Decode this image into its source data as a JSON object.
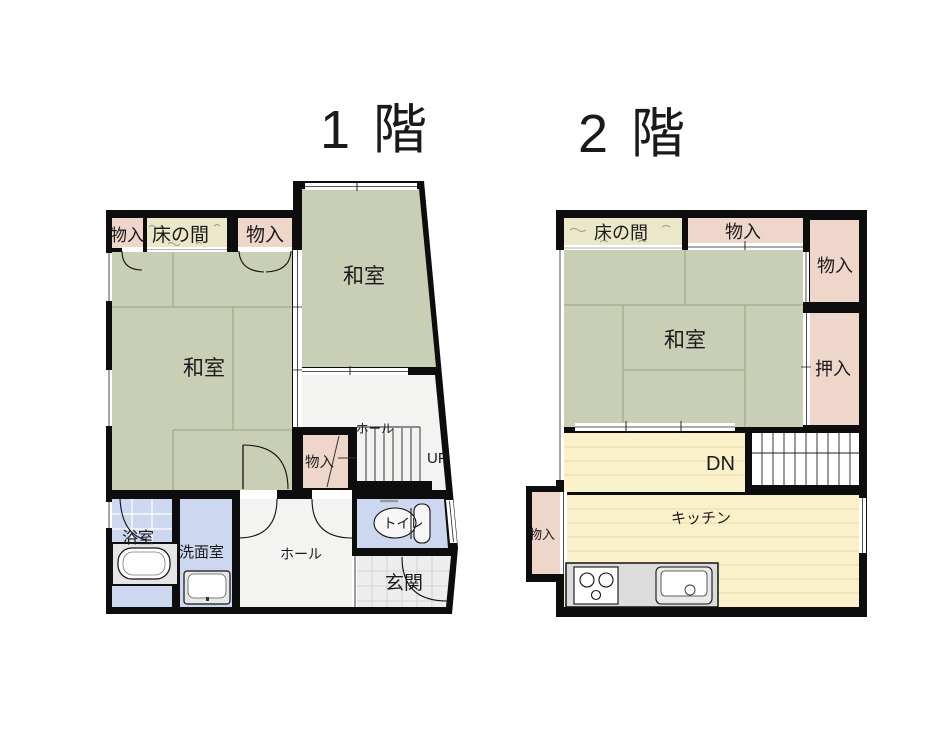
{
  "titles": {
    "floor1": "1 階",
    "floor2": "2 階"
  },
  "floor1": {
    "storage_top_left": "物入",
    "tokonoma": "床の間",
    "storage_top_right": "物入",
    "washitsu_right": "和室",
    "washitsu_left": "和室",
    "hall_upper": "ホール",
    "storage_middle": "物入",
    "stairs_up": "UP",
    "bathroom": "浴室",
    "washroom": "洗面室",
    "hall_lower": "ホール",
    "toilet": "トイレ",
    "entrance": "玄関"
  },
  "floor2": {
    "tokonoma": "床の間",
    "storage_top": "物入",
    "storage_right": "物入",
    "washitsu": "和室",
    "oshiire": "押入",
    "stairs_down": "DN",
    "kitchen": "キッチン",
    "storage_left": "物入"
  },
  "colors": {
    "wall": "#0d0d0d",
    "tatami": "#c9cfb4",
    "storage_pink": "#eed6cb",
    "tokonoma_cream": "#eae8c9",
    "water_blue": "#cdd8f0",
    "wood_floor": "#faf0ca",
    "room_white": "#f3f3f1",
    "entrance_tile": "#ededed",
    "counter_gray": "#dcdcdc",
    "fixture_white": "#f7f7f7",
    "stair_text": "#555555"
  }
}
